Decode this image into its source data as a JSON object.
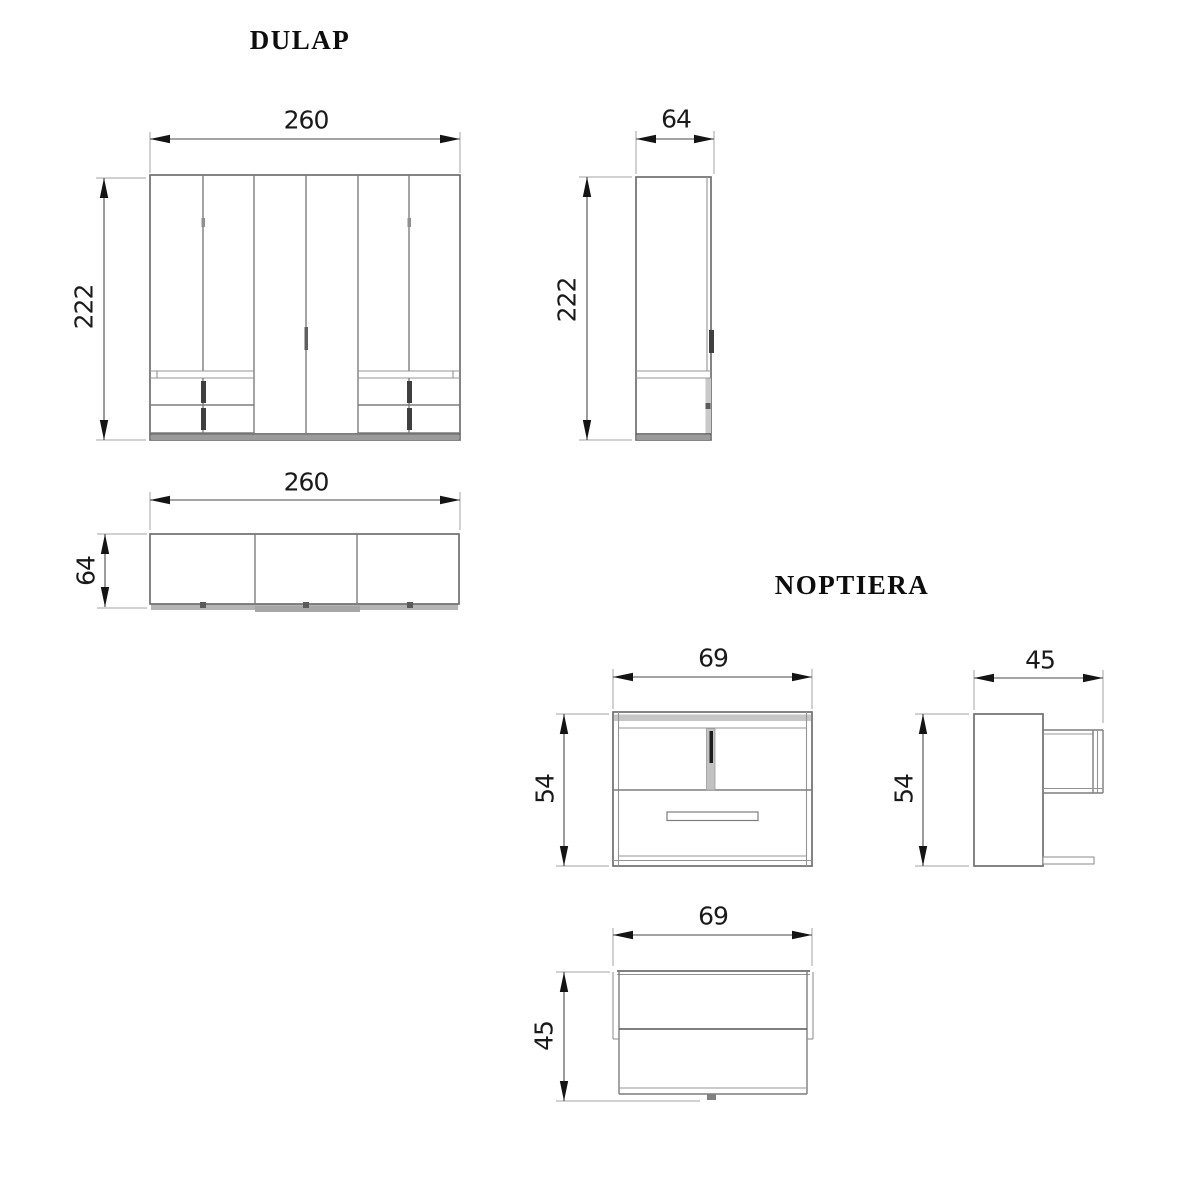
{
  "colors": {
    "line_gray": "#6f6f6f",
    "light_fill_gray": "#c6c6c6",
    "plinth_gray": "#9b9b9b",
    "handle_dark": "#1c1c1c",
    "text_black": "#111111"
  },
  "wardrobe": {
    "title": "DULAP",
    "front_view": {
      "width": "260",
      "height": "222"
    },
    "side_view": {
      "depth": "64",
      "height": "222"
    },
    "top_view": {
      "width": "260",
      "depth": "64"
    }
  },
  "nightstand": {
    "title": "NOPTIERA",
    "front_view": {
      "width": "69",
      "height": "54"
    },
    "side_view": {
      "depth": "45",
      "height": "54"
    },
    "top_view": {
      "width": "69",
      "depth": "45"
    }
  }
}
